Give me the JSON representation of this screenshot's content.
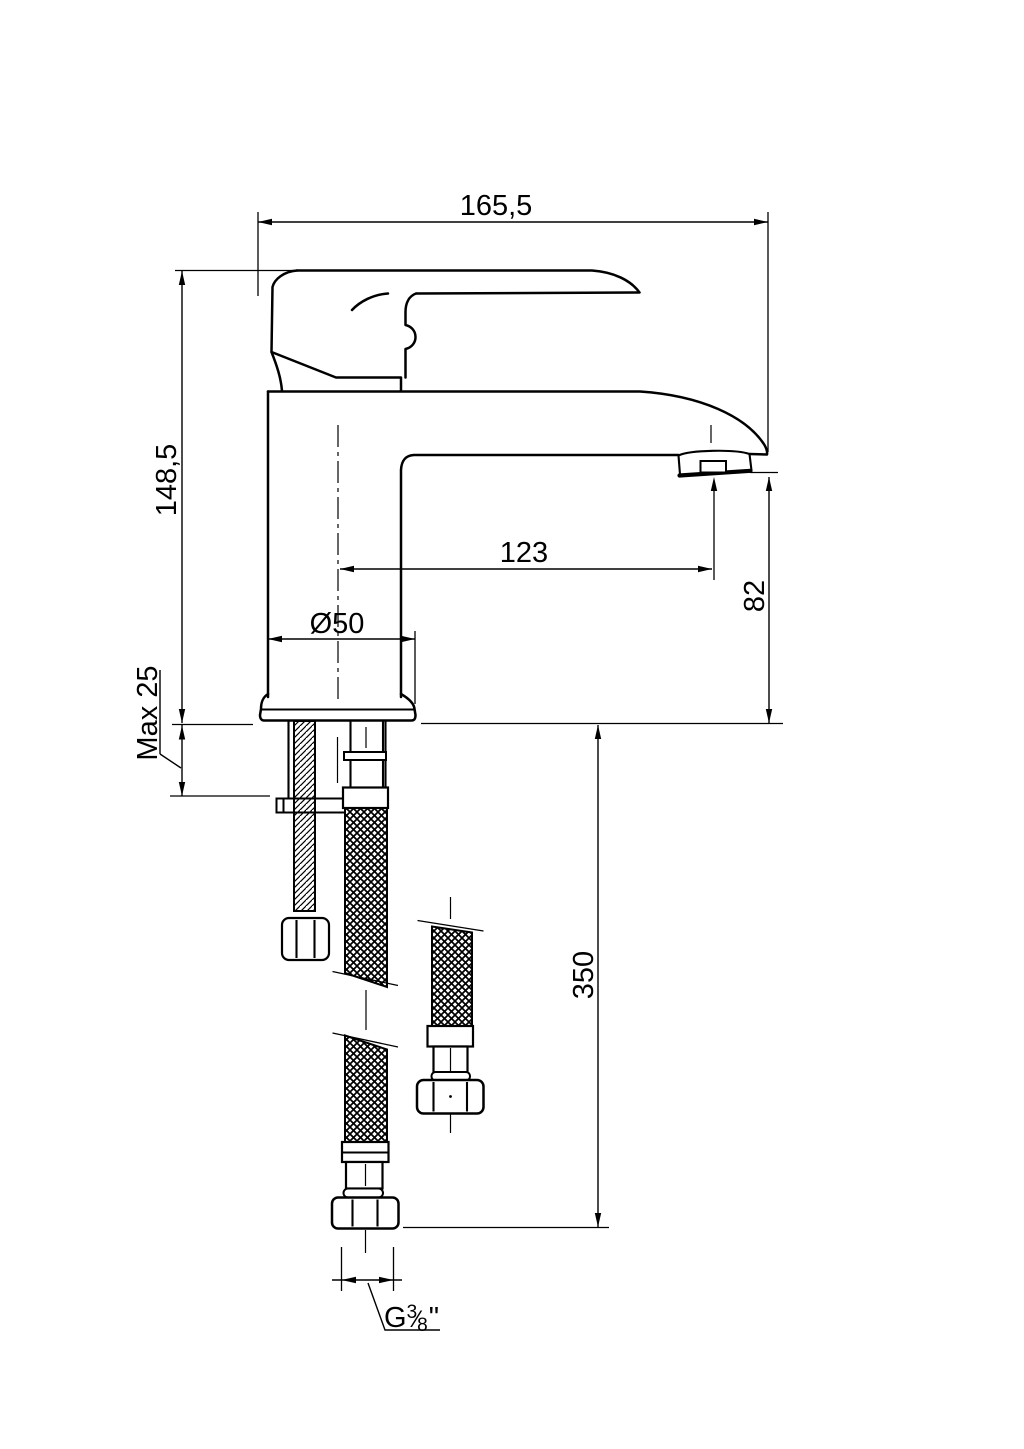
{
  "drawing": {
    "title": "Single-lever basin mixer faucet — dimensional technical drawing",
    "background": "#ffffff",
    "line_color": "#000000",
    "dimensions": {
      "total_width": "165,5",
      "total_height": "148,5",
      "max_deck_thickness": "Max 25",
      "base_diameter": "Ø50",
      "spout_reach": "123",
      "spout_outlet_height": "82",
      "hose_length": "350",
      "thread": {
        "prefix": "G",
        "numerator": "3",
        "slash": "⁄",
        "denominator": "8",
        "suffix": "\""
      }
    }
  }
}
